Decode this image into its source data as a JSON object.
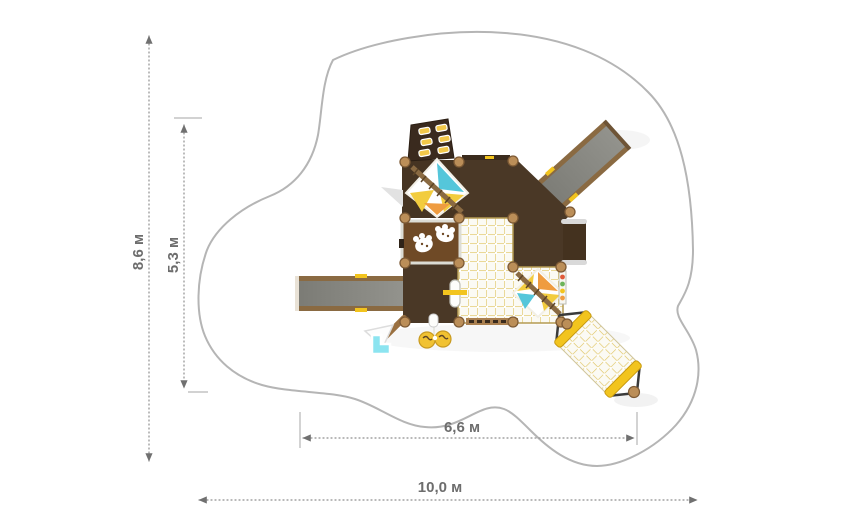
{
  "drawing": {
    "type": "playground-top-view-plan",
    "dimensions": {
      "safety_zone_height": "8,6 м",
      "equipment_height": "5,3 м",
      "equipment_width": "6,6 м",
      "safety_zone_width": "10,0 м"
    },
    "colors": {
      "safety_zone_outline": "#b5b5b5",
      "dimension_line": "#8f8f8f",
      "dimension_label": "#6d6d6d",
      "platform_dark_brown": "#4a3826",
      "panel_brown": "#6f4a26",
      "wood_post": "#bb8e58",
      "slide_gray": "#8b8b85",
      "roof_cyan": "#55c6da",
      "roof_yellow": "#f2cc3e",
      "roof_orange": "#ef9c40",
      "net_line_yellow": "#dfc35e",
      "toy_yellow": "#f1c232",
      "toy_cyan": "#8ce4f0"
    },
    "elements": [
      "safety-zone-outline",
      "climbing-wall",
      "pyramid-roof-top",
      "pyramid-roof-net",
      "game-panel-paws",
      "net-floor",
      "left-slide",
      "right-slide",
      "net-bridge",
      "balcony",
      "abacus-beads",
      "roller-capsule",
      "binoculars-toy",
      "splash-toy"
    ]
  }
}
